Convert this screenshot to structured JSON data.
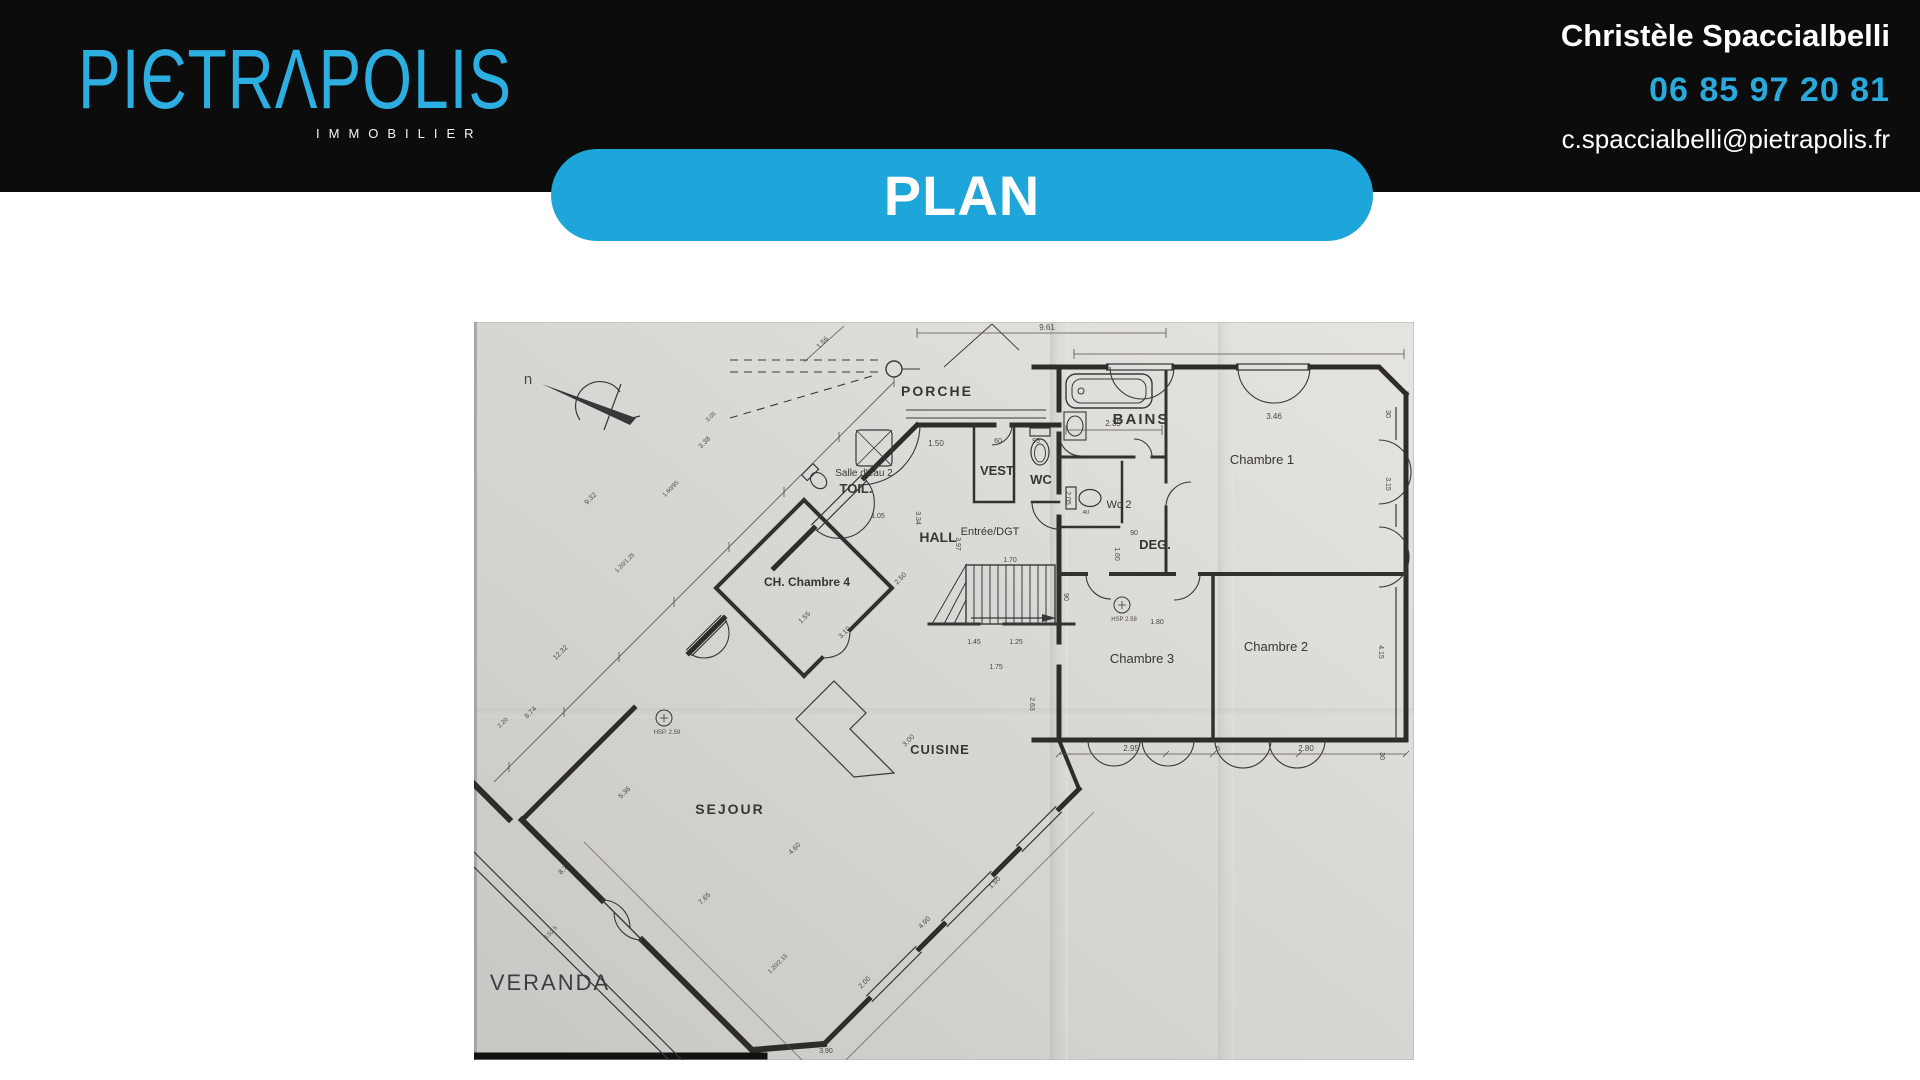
{
  "header": {
    "logo_text": "PIЄTRΛPOLIS",
    "logo_brand": "PIETRAPOLIS",
    "tagline": "IMMOBILIER",
    "bg_color": "#0c0c0c",
    "accent_color": "#29a9dc",
    "logo_color": "#2daee0"
  },
  "contact": {
    "name": "Christèle Spaccialbelli",
    "phone": "06 85 97 20 81",
    "email": "c.spaccialbelli@pietrapolis.fr"
  },
  "banner": {
    "label": "PLAN"
  },
  "plan": {
    "paper_color": "#d6d4d0",
    "ink_color": "#383633",
    "compass_label": "n",
    "room_labels": [
      {
        "t": "PORCHE",
        "x": 463,
        "y": 74,
        "fs": 14,
        "b": 1,
        "ls": 2
      },
      {
        "t": "BAINS",
        "x": 667,
        "y": 102,
        "fs": 15,
        "b": 1,
        "ls": 2
      },
      {
        "t": "Chambre 1",
        "x": 788,
        "y": 142,
        "fs": 13
      },
      {
        "t": "Salle d'eau 2",
        "x": 390,
        "y": 154,
        "fs": 10
      },
      {
        "t": "TOIL.",
        "x": 382,
        "y": 171,
        "fs": 13,
        "b": 1
      },
      {
        "t": "VEST.",
        "x": 524,
        "y": 153,
        "fs": 13,
        "b": 1
      },
      {
        "t": "WC",
        "x": 567,
        "y": 162,
        "fs": 13,
        "b": 1
      },
      {
        "t": "Wc 2",
        "x": 645,
        "y": 186,
        "fs": 11
      },
      {
        "t": "HALL",
        "x": 464,
        "y": 220,
        "fs": 14,
        "b": 1
      },
      {
        "t": "Entrée/DGT",
        "x": 516,
        "y": 213,
        "fs": 11
      },
      {
        "t": "DEG.",
        "x": 681,
        "y": 227,
        "fs": 13,
        "b": 1
      },
      {
        "t": "CH. Chambre 4",
        "x": 333,
        "y": 264,
        "fs": 12,
        "b": 1
      },
      {
        "t": "Chambre 3",
        "x": 668,
        "y": 341,
        "fs": 13
      },
      {
        "t": "Chambre 2",
        "x": 802,
        "y": 329,
        "fs": 13
      },
      {
        "t": "CUISINE",
        "x": 466,
        "y": 432,
        "fs": 13,
        "b": 1,
        "ls": 1
      },
      {
        "t": "SEJOUR",
        "x": 256,
        "y": 492,
        "fs": 14,
        "b": 1,
        "ls": 2
      },
      {
        "t": "VERANDA",
        "x": 76,
        "y": 668,
        "fs": 22,
        "cls": "overlay"
      }
    ],
    "dim_labels": [
      {
        "t": "9.61",
        "x": 573,
        "y": 8,
        "fs": 8
      },
      {
        "t": "1.56",
        "x": 350,
        "y": 22,
        "fs": 7,
        "r": -45
      },
      {
        "t": "2.35",
        "x": 639,
        "y": 104,
        "fs": 8
      },
      {
        "t": "3.46",
        "x": 800,
        "y": 97,
        "fs": 8
      },
      {
        "t": "30",
        "x": 912,
        "y": 92,
        "fs": 7,
        "r": 90
      },
      {
        "t": "3.15",
        "x": 912,
        "y": 162,
        "fs": 7,
        "r": 90
      },
      {
        "t": "5",
        "x": 896,
        "y": 252,
        "fs": 7,
        "r": 90
      },
      {
        "t": "4.15",
        "x": 905,
        "y": 330,
        "fs": 7,
        "r": 90
      },
      {
        "t": "2.95",
        "x": 657,
        "y": 429,
        "fs": 8
      },
      {
        "t": "5",
        "x": 744,
        "y": 429,
        "fs": 7
      },
      {
        "t": "2.80",
        "x": 832,
        "y": 429,
        "fs": 8
      },
      {
        "t": "30",
        "x": 906,
        "y": 434,
        "fs": 7,
        "r": 90
      },
      {
        "t": "1.50",
        "x": 462,
        "y": 124,
        "fs": 8
      },
      {
        "t": "60",
        "x": 524,
        "y": 121,
        "fs": 7
      },
      {
        "t": "95",
        "x": 562,
        "y": 121,
        "fs": 7
      },
      {
        "t": "1.05",
        "x": 404,
        "y": 196,
        "fs": 7
      },
      {
        "t": "3.34",
        "x": 442,
        "y": 196,
        "fs": 7,
        "r": 90
      },
      {
        "t": "3.97",
        "x": 482,
        "y": 222,
        "fs": 7,
        "r": 90
      },
      {
        "t": "2.05",
        "x": 592,
        "y": 176,
        "fs": 7,
        "r": 90
      },
      {
        "t": "1.45",
        "x": 500,
        "y": 322,
        "fs": 7
      },
      {
        "t": "1.25",
        "x": 542,
        "y": 322,
        "fs": 7
      },
      {
        "t": "1.70",
        "x": 536,
        "y": 240,
        "fs": 7
      },
      {
        "t": "90",
        "x": 590,
        "y": 275,
        "fs": 7,
        "r": 90
      },
      {
        "t": "1.80",
        "x": 683,
        "y": 302,
        "fs": 7
      },
      {
        "t": "1.60",
        "x": 641,
        "y": 232,
        "fs": 7,
        "r": 90
      },
      {
        "t": "90",
        "x": 660,
        "y": 213,
        "fs": 7
      },
      {
        "t": "40",
        "x": 612,
        "y": 192,
        "fs": 6
      },
      {
        "t": "1.75",
        "x": 522,
        "y": 347,
        "fs": 7
      },
      {
        "t": "2.63",
        "x": 556,
        "y": 382,
        "fs": 7,
        "r": 90
      },
      {
        "t": "3.00",
        "x": 436,
        "y": 420,
        "fs": 7,
        "r": -45
      },
      {
        "t": "3.10",
        "x": 372,
        "y": 312,
        "fs": 7,
        "r": -45
      },
      {
        "t": "2.50",
        "x": 428,
        "y": 258,
        "fs": 7,
        "r": -45
      },
      {
        "t": "1.55",
        "x": 332,
        "y": 297,
        "fs": 7,
        "r": -45
      },
      {
        "t": "4.60",
        "x": 322,
        "y": 528,
        "fs": 7,
        "r": -45
      },
      {
        "t": "7.65",
        "x": 232,
        "y": 578,
        "fs": 7,
        "r": -45
      },
      {
        "t": "5.36",
        "x": 152,
        "y": 472,
        "fs": 7,
        "r": -45
      },
      {
        "t": "1.20/2.15",
        "x": 305,
        "y": 643,
        "fs": 6,
        "r": -45
      },
      {
        "t": "2.00",
        "x": 392,
        "y": 662,
        "fs": 7,
        "r": -45
      },
      {
        "t": "4.90",
        "x": 452,
        "y": 602,
        "fs": 7,
        "r": -45
      },
      {
        "t": "1.50",
        "x": 522,
        "y": 562,
        "fs": 7,
        "r": -45
      },
      {
        "t": "8.75",
        "x": 92,
        "y": 548,
        "fs": 7,
        "r": -45
      },
      {
        "t": "3.52 5",
        "x": 78,
        "y": 612,
        "fs": 6,
        "r": -45
      },
      {
        "t": "9.32",
        "x": 118,
        "y": 178,
        "fs": 7,
        "r": -45
      },
      {
        "t": "1.20/1.25",
        "x": 152,
        "y": 242,
        "fs": 6,
        "r": -45
      },
      {
        "t": "3.38",
        "x": 232,
        "y": 122,
        "fs": 7,
        "r": -45
      },
      {
        "t": "12.32",
        "x": 88,
        "y": 332,
        "fs": 7,
        "r": -45
      },
      {
        "t": "8.74",
        "x": 58,
        "y": 392,
        "fs": 7,
        "r": -45
      },
      {
        "t": "1.60/95",
        "x": 198,
        "y": 168,
        "fs": 6,
        "r": -45
      },
      {
        "t": "3.05",
        "x": 238,
        "y": 96,
        "fs": 6,
        "r": -45
      },
      {
        "t": "2.20",
        "x": 30,
        "y": 402,
        "fs": 6,
        "r": -45
      },
      {
        "t": "3.90",
        "x": 352,
        "y": 731,
        "fs": 7
      },
      {
        "t": "HSP 2.58",
        "x": 650,
        "y": 299,
        "fs": 6
      },
      {
        "t": "HSP. 2.59",
        "x": 193,
        "y": 412,
        "fs": 6
      },
      {
        "t": "n",
        "x": 54,
        "y": 62,
        "fs": 15
      }
    ]
  }
}
